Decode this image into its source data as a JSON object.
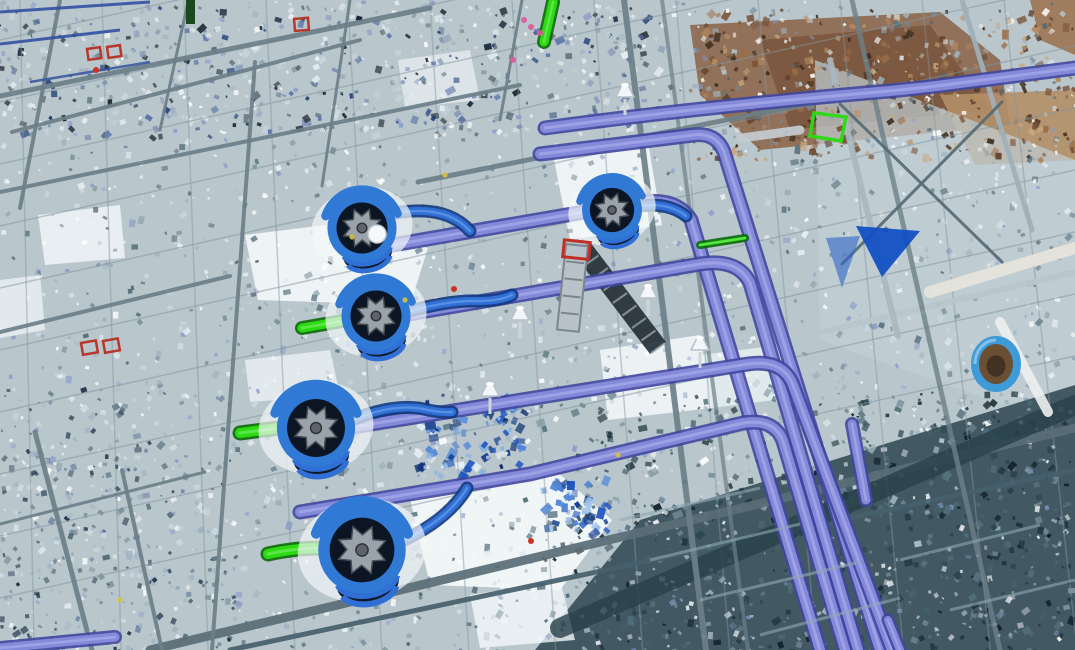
{
  "meta": {
    "type": "3d-point-cloud-viewport",
    "content": "Aerial laser-scan point cloud of an industrial plant mechanical room overlaid with BIM model objects: five blue pump volutes with gear impellers, lavender pipe headers bending toward lower right, bright green suction stubs, structural steel grid, brown scan patches at top right, dark mezzanine at bottom right, blue triangle marker and blue-wrapped drum on the right."
  },
  "colors": {
    "base": "#b9c6cc",
    "steel": "#6d8089",
    "steel_light": "#a9b8c0",
    "pipe_main": "#8489da",
    "pipe_edge": "#41479e",
    "pipe_lite": "#b8bbf0",
    "blue_pipe": "#2f6fd6",
    "blue_pipe_edge": "#123a80",
    "green_pipe": "#2bdb12",
    "green_edge": "#0a6a08",
    "pump_blue": "#3079d4",
    "pump_dark": "#0c1524",
    "gear_gray": "#9aa3ab",
    "marker_blue": "#1250c4",
    "red_marker": "#b8372b",
    "brown_zone": "#8a6244",
    "dark_zone": "#3b525c",
    "white_patch": "#f4f8fa"
  },
  "scene": {
    "zones": [
      {
        "name": "brown-pointcloud-zone",
        "pts": "690,25 940,12 1000,60 1010,125 760,150 700,95",
        "fill": "#8a6244",
        "op": 0.85
      },
      {
        "name": "brown-pointcloud-inner",
        "pts": "760,40 930,25 990,110 790,130",
        "fill": "#6e4a30",
        "op": 0.6
      },
      {
        "name": "tan-band",
        "pts": "940,95 1075,90 1075,160 975,165",
        "fill": "#b28f68",
        "op": 0.9
      },
      {
        "name": "brown-corner",
        "pts": "1030,0 1075,0 1075,55 1040,40",
        "fill": "#9a6a44",
        "op": 0.8
      },
      {
        "name": "right-platform",
        "pts": "815,60 1075,160 1075,430 820,340",
        "fill": "#c2ced4",
        "op": 0.7
      },
      {
        "name": "dark-mezzanine-zone",
        "pts": "535,650 640,520 1075,385 1075,650",
        "fill": "#3b525c",
        "op": 0.95
      },
      {
        "name": "white-floor-patch",
        "pts": "245,235 350,222 428,248 410,305 258,300",
        "fill": "#f4f8fa",
        "op": 0.9
      },
      {
        "name": "white-floor-patch",
        "pts": "552,150 648,142 662,225 570,240",
        "fill": "#f4f8fa",
        "op": 0.9
      },
      {
        "name": "white-floor-patch",
        "pts": "408,490 555,470 612,520 560,590 430,585",
        "fill": "#f4f8fa",
        "op": 0.92
      },
      {
        "name": "white-floor-patch",
        "pts": "600,350 700,335 712,408 608,420",
        "fill": "#f4f8fa",
        "op": 0.85
      },
      {
        "name": "white-floor-patch",
        "pts": "38,215 120,205 125,258 45,265",
        "fill": "#f4f8fa",
        "op": 0.8
      },
      {
        "name": "white-floor-patch",
        "pts": "245,360 330,350 340,395 250,402",
        "fill": "#f4f8fa",
        "op": 0.7
      },
      {
        "name": "white-floor-patch",
        "pts": "398,60 470,50 480,100 405,108",
        "fill": "#f4f8fa",
        "op": 0.6
      },
      {
        "name": "white-floor-patch",
        "pts": "470,595 560,580 575,640 480,648",
        "fill": "#f4f8fa",
        "op": 0.8
      },
      {
        "name": "white-floor-patch",
        "pts": "0,280 40,275 45,330 0,338",
        "fill": "#f4f8fa",
        "op": 0.7
      },
      {
        "name": "white-floor-patch",
        "pts": "700,355 780,345 790,398 712,408",
        "fill": "#eef4f6",
        "op": 0.75
      }
    ],
    "noise": [
      {
        "name": "pointcloud-speckle-base",
        "x": 0,
        "y": 0,
        "w": 1075,
        "h": 650,
        "count": 2100,
        "sizes": [
          2,
          6
        ],
        "palette": [
          "#ffffff",
          "#dfe9ee",
          "#9fb3bd",
          "#728a96",
          "#55707c",
          "#8899c8",
          "#cdd9de",
          "#4a6470",
          "#b6c6ce"
        ],
        "op": [
          0.35,
          0.9
        ]
      },
      {
        "name": "pointcloud-speckle-topband",
        "x": 0,
        "y": 0,
        "w": 660,
        "h": 135,
        "count": 420,
        "sizes": [
          2,
          7
        ],
        "palette": [
          "#24427a",
          "#0f1c30",
          "#5872a8",
          "#c6d2da",
          "#202830",
          "#8a98b8",
          "#e8eef2"
        ],
        "op": [
          0.4,
          0.95
        ]
      },
      {
        "name": "pointcloud-speckle-brown",
        "x": 690,
        "y": 8,
        "w": 385,
        "h": 150,
        "count": 330,
        "sizes": [
          2,
          7
        ],
        "palette": [
          "#7a5236",
          "#9a6c47",
          "#b5895e",
          "#5c3d28",
          "#c9a87c",
          "#3e2c1c"
        ],
        "op": [
          0.5,
          0.95
        ]
      },
      {
        "name": "pointcloud-speckle-dark",
        "x": 540,
        "y": 390,
        "w": 535,
        "h": 260,
        "count": 520,
        "sizes": [
          2,
          7
        ],
        "palette": [
          "#1e333c",
          "#2c454f",
          "#51707c",
          "#0f2129",
          "#6d8893",
          "#42606c"
        ],
        "op": [
          0.5,
          0.95
        ]
      },
      {
        "name": "blue-parts-cluster",
        "x": 418,
        "y": 392,
        "w": 105,
        "h": 80,
        "count": 95,
        "sizes": [
          3,
          9
        ],
        "palette": [
          "#2257c0",
          "#4f86d8",
          "#173f8f",
          "#7fb0e8",
          "#0d2f70",
          "#e8f0f8"
        ],
        "op": [
          0.6,
          1
        ]
      },
      {
        "name": "blue-parts-cluster-small",
        "x": 545,
        "y": 475,
        "w": 65,
        "h": 55,
        "count": 42,
        "sizes": [
          3,
          8
        ],
        "palette": [
          "#2257c0",
          "#4f86d8",
          "#173f8f",
          "#9fc2e8"
        ],
        "op": [
          0.6,
          1
        ]
      },
      {
        "name": "white-sparkle",
        "x": 0,
        "y": 0,
        "w": 1075,
        "h": 650,
        "count": 450,
        "sizes": [
          2,
          5
        ],
        "palette": [
          "#ffffff",
          "#eef4f7"
        ],
        "op": [
          0.5,
          0.9
        ]
      },
      {
        "name": "left-truss-speckle",
        "x": 0,
        "y": 380,
        "w": 240,
        "h": 270,
        "count": 260,
        "sizes": [
          2,
          6
        ],
        "palette": [
          "#31475a",
          "#6d84a0",
          "#12233a",
          "#9fb3c6",
          "#d5e0e8"
        ],
        "op": [
          0.4,
          0.9
        ]
      }
    ],
    "grid": {
      "shallow": {
        "count": 10,
        "y0": 40,
        "step": 62,
        "drop": -242,
        "w": 1.5,
        "op": 0.5
      },
      "steep": {
        "count": 13,
        "x0": 20,
        "step": 82,
        "w": 1.5,
        "op": 0.45
      }
    },
    "beams": [
      {
        "x1": 0,
        "y1": 96,
        "x2": 430,
        "y2": 8,
        "w": 5
      },
      {
        "x1": 0,
        "y1": 192,
        "x2": 520,
        "y2": 85,
        "w": 4
      },
      {
        "x1": 12,
        "y1": 132,
        "x2": 360,
        "y2": 40,
        "w": 4
      },
      {
        "x1": 0,
        "y1": 332,
        "x2": 230,
        "y2": 276,
        "w": 4
      },
      {
        "x1": 418,
        "y1": 182,
        "x2": 905,
        "y2": 84,
        "w": 5
      },
      {
        "x1": 150,
        "y1": 650,
        "x2": 1075,
        "y2": 428,
        "w": 9,
        "c": "#5a6e78"
      },
      {
        "x1": 230,
        "y1": 650,
        "x2": 1075,
        "y2": 470,
        "w": 5,
        "c": "#46606c"
      },
      {
        "x1": 560,
        "y1": 628,
        "x2": 1075,
        "y2": 405,
        "w": 20,
        "c": "#28414b",
        "op": 0.8
      },
      {
        "x1": 822,
        "y1": 332,
        "x2": 1075,
        "y2": 272,
        "w": 6,
        "c": "#b9c6cc"
      },
      {
        "x1": 60,
        "y1": 0,
        "x2": 20,
        "y2": 208,
        "w": 4
      },
      {
        "x1": 188,
        "y1": 2,
        "x2": 160,
        "y2": 130,
        "w": 3
      },
      {
        "x1": 255,
        "y1": 62,
        "x2": 212,
        "y2": 650,
        "w": 4
      },
      {
        "x1": 624,
        "y1": 0,
        "x2": 706,
        "y2": 650,
        "w": 6
      },
      {
        "x1": 662,
        "y1": 0,
        "x2": 748,
        "y2": 650,
        "w": 4,
        "op": 0.7
      },
      {
        "x1": 852,
        "y1": 0,
        "x2": 1000,
        "y2": 650,
        "w": 5,
        "op": 0.8
      },
      {
        "x1": 830,
        "y1": 60,
        "x2": 898,
        "y2": 336,
        "w": 6,
        "c": "#aab8c0"
      },
      {
        "x1": 962,
        "y1": 0,
        "x2": 1032,
        "y2": 230,
        "w": 5,
        "c": "#9fb0ba"
      },
      {
        "x1": 840,
        "y1": 104,
        "x2": 1002,
        "y2": 262,
        "w": 3,
        "c": "#576b76"
      },
      {
        "x1": 1002,
        "y1": 102,
        "x2": 842,
        "y2": 264,
        "w": 3,
        "c": "#576b76"
      },
      {
        "x1": 35,
        "y1": 432,
        "x2": 92,
        "y2": 650,
        "w": 5
      },
      {
        "x1": 122,
        "y1": 470,
        "x2": 162,
        "y2": 650,
        "w": 4
      },
      {
        "x1": 0,
        "y1": 524,
        "x2": 205,
        "y2": 472,
        "w": 3
      },
      {
        "x1": 350,
        "y1": 0,
        "x2": 322,
        "y2": 186,
        "w": 3
      },
      {
        "x1": 522,
        "y1": 0,
        "x2": 500,
        "y2": 120,
        "w": 3
      },
      {
        "x1": 742,
        "y1": 138,
        "x2": 800,
        "y2": 130,
        "w": 9,
        "c": "#c6ccd0"
      },
      {
        "x1": 930,
        "y1": 292,
        "x2": 1075,
        "y2": 248,
        "w": 12,
        "c": "#e9e6dc",
        "op": 0.9
      },
      {
        "x1": 1000,
        "y1": 322,
        "x2": 1048,
        "y2": 412,
        "w": 10,
        "c": "#eef0f0",
        "op": 0.9
      }
    ],
    "cables": [
      {
        "x1": 0,
        "y1": 12,
        "x2": 150,
        "y2": 2,
        "w": 3,
        "c": "#2c4aa0"
      },
      {
        "x1": 0,
        "y1": 44,
        "x2": 120,
        "y2": 30,
        "w": 3,
        "c": "#2c4aa0"
      },
      {
        "x1": 30,
        "y1": 82,
        "x2": 150,
        "y2": 62,
        "w": 2.5,
        "c": "#35539f"
      }
    ],
    "pipes": [
      {
        "name": "top-header-pipe",
        "d": "M545,128 Q700,107 890,91 Q930,87 952,84 L1075,68",
        "w": 10
      },
      {
        "name": "header-pipe",
        "d": "M540,154 L693,135 Q716,132 724,152 L880,650",
        "w": 10
      },
      {
        "name": "header-pipe",
        "d": "M352,252 L636,203 Q676,196 691,220 L820,650",
        "w": 10
      },
      {
        "name": "header-pipe",
        "d": "M362,322 L700,264 Q738,258 750,283 L858,650",
        "w": 10
      },
      {
        "name": "header-pipe",
        "d": "M346,428 L748,364 Q783,359 793,385 L892,650",
        "w": 10
      },
      {
        "name": "header-pipe",
        "d": "M300,512 L530,474 L743,423 Q774,418 783,441 L845,650",
        "w": 10
      },
      {
        "name": "header-stub",
        "d": "M0,648 L115,637",
        "w": 9
      },
      {
        "name": "header-stub",
        "d": "M852,424 L866,500",
        "w": 9
      },
      {
        "name": "header-stub",
        "d": "M888,620 L900,650",
        "w": 8
      }
    ],
    "discharges": [
      {
        "name": "pump-discharge-pipe",
        "d": "M390,214 Q445,203 470,231",
        "w": 8
      },
      {
        "name": "pump-discharge-pipe",
        "d": "M406,312 Q450,300 478,301 Q500,301 512,295",
        "w": 8
      },
      {
        "name": "pump-discharge-pipe",
        "d": "M640,206 Q668,202 686,216",
        "w": 8
      },
      {
        "name": "pump-discharge-pipe",
        "d": "M352,420 Q396,402 428,410 Q444,413 452,412",
        "w": 8
      },
      {
        "name": "pump-discharge-pipe",
        "d": "M400,542 Q448,520 467,488",
        "w": 8
      }
    ],
    "greens": [
      {
        "name": "green-suction-stub",
        "d": "M302,328 L354,319",
        "w": 9
      },
      {
        "name": "green-suction-stub",
        "d": "M240,433 L302,425",
        "w": 10
      },
      {
        "name": "green-suction-stub",
        "d": "M268,554 Q306,546 332,549",
        "w": 10
      },
      {
        "name": "green-riser",
        "d": "M553,2 L544,42",
        "w": 9
      },
      {
        "name": "green-thin-line",
        "d": "M700,245 L745,238",
        "w": 3
      }
    ],
    "green_rect": {
      "name": "green-tray-outline",
      "pts": "814,113 846,117 841,141 810,136"
    },
    "dark_green_bar": {
      "x": 186,
      "y": 0,
      "w": 9,
      "h": 24,
      "fill": "#184a1e"
    },
    "pumps": [
      {
        "name": "pump",
        "cx": 362,
        "cy": 228,
        "r": 30,
        "rot": -12,
        "ball": true
      },
      {
        "name": "pump",
        "cx": 376,
        "cy": 316,
        "r": 30,
        "rot": -12,
        "ball": false
      },
      {
        "name": "pump",
        "cx": 612,
        "cy": 210,
        "r": 26,
        "rot": -15,
        "ball": false
      },
      {
        "name": "pump",
        "cx": 316,
        "cy": 428,
        "r": 34,
        "rot": -10,
        "ball": false
      },
      {
        "name": "pump",
        "cx": 362,
        "cy": 550,
        "r": 38,
        "rot": -10,
        "ball": false
      }
    ],
    "triangles": [
      {
        "name": "blue-triangle-marker",
        "pts": "856,226 920,231 882,277",
        "fill": "#1250c4",
        "op": 0.95
      },
      {
        "name": "blue-triangle-marker",
        "pts": "826,238 860,236 842,288",
        "fill": "#2e66c8",
        "op": 0.6
      }
    ],
    "ring": {
      "name": "blue-wrapped-drum",
      "cx": 996,
      "cy": 364,
      "rx": 21,
      "ry": 24,
      "stroke": "#3f9ad8",
      "inner": "#6b4f33"
    },
    "red_squares": [
      {
        "x": 87,
        "y": 49,
        "w": 13,
        "h": 11,
        "rot": -8
      },
      {
        "x": 107,
        "y": 47,
        "w": 13,
        "h": 11,
        "rot": -8
      },
      {
        "x": 294,
        "y": 19,
        "w": 14,
        "h": 12,
        "rot": -5
      },
      {
        "x": 81,
        "y": 343,
        "w": 15,
        "h": 12,
        "rot": -10
      },
      {
        "x": 103,
        "y": 341,
        "w": 15,
        "h": 12,
        "rot": -10
      }
    ],
    "red_dots": [
      [
        454,
        289
      ],
      [
        531,
        541
      ],
      [
        96,
        70
      ]
    ],
    "magenta_dots": [
      [
        531,
        27
      ],
      [
        540,
        33
      ],
      [
        524,
        20
      ],
      [
        513,
        60
      ]
    ],
    "yellow_dots": [
      [
        405,
        300
      ],
      [
        445,
        175
      ],
      [
        618,
        455
      ],
      [
        352,
        237
      ],
      [
        120,
        600
      ]
    ],
    "ladder": {
      "name": "ladder-with-red-top",
      "x": 566,
      "y": 244,
      "w": 22,
      "h": 86,
      "rot": 6,
      "capx": 564,
      "capy": 240,
      "capw": 26,
      "caph": 17
    },
    "stair": {
      "name": "stair-band",
      "x1": 582,
      "y1": 248,
      "x2": 658,
      "y2": 348,
      "w": 20,
      "c": "#232d36",
      "rungs": 8
    },
    "funnels": [
      [
        520,
        322
      ],
      [
        490,
        398
      ],
      [
        648,
        300
      ],
      [
        625,
        99
      ],
      [
        700,
        352
      ]
    ],
    "streaks": [
      {
        "x1": 620,
        "y1": 520,
        "x2": 760,
        "y2": 488
      },
      {
        "x1": 650,
        "y1": 560,
        "x2": 800,
        "y2": 524
      },
      {
        "x1": 700,
        "y1": 600,
        "x2": 860,
        "y2": 562
      },
      {
        "x1": 760,
        "y1": 635,
        "x2": 900,
        "y2": 598
      },
      {
        "x1": 900,
        "y1": 560,
        "x2": 1040,
        "y2": 525
      },
      {
        "x1": 950,
        "y1": 610,
        "x2": 1075,
        "y2": 580
      }
    ]
  }
}
